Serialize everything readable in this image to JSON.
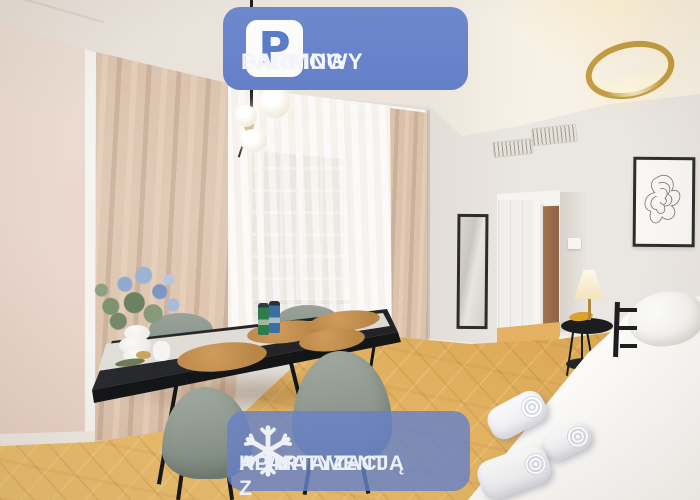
{
  "type": "apartment-listing-photo",
  "badges": {
    "parking": {
      "icon": "parking-icon",
      "icon_letter": "P",
      "line1": "DARMOWY",
      "line2": "PARKING",
      "background": "#6983ca",
      "icon_bg": "#fbfbfa",
      "icon_color": "#5b7cc9",
      "text_color": "#f3f5fa"
    },
    "air_conditioning": {
      "icon": "snowflake-icon",
      "line1": "APARTAMENT Z",
      "line2": "KLIMATYZACJĄ",
      "background": "rgba(103,129,199,0.82)",
      "icon_color": "#edf1f6",
      "text_color": "#ebeff6"
    }
  },
  "scene": {
    "description": "Bright studio apartment: black dining table set for four with cork placemats, bottles and flower vase, sage shell chairs, beige curtains with sheer balcony window, globe chandelier, gold ring ceiling lamp, tall mirror, hallway with wardrobe and wooden door, framed line art, bedside table with lit brass lamp, white bed with rolled towels, herringbone oak floor.",
    "colors": {
      "curtain": "#dcc5b1",
      "wall_left": "#e9d6cc",
      "wall_right": "#eae6e1",
      "ceiling": "#f5f0e8",
      "floor": "#d9a656",
      "table": "#232428",
      "chairs": "#93a097",
      "bed": "#f7f6f4",
      "accent_gold": "#c39d43"
    }
  }
}
